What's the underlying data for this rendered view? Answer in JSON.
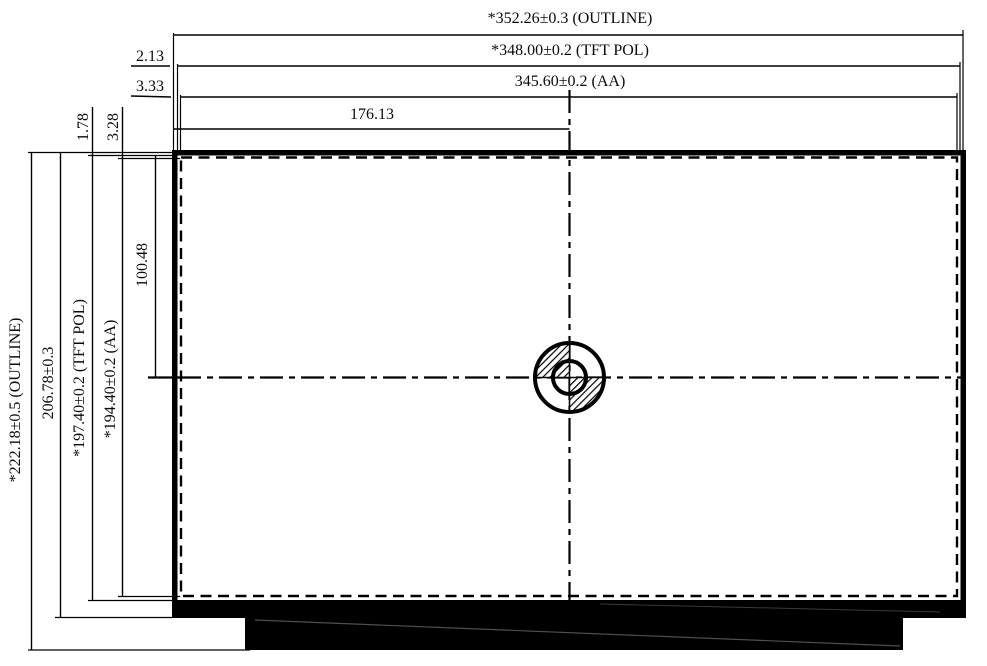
{
  "meta": {
    "type": "mechanical-outline-drawing",
    "subject": "TFT LCD module outline and active-area dimensions",
    "units": "mm"
  },
  "dimensions": {
    "horizontal": {
      "outline": "*352.26±0.3 (OUTLINE)",
      "tft_pol": "*348.00±0.2 (TFT POL)",
      "active_area": "345.60±0.2 (AA)",
      "center_offset": "176.13",
      "pol_edge_gap": "2.13",
      "aa_edge_gap": "3.33"
    },
    "vertical": {
      "outline": "*222.18±0.5 (OUTLINE)",
      "glass": "206.78±0.3",
      "tft_pol": "*197.40±0.2 (TFT POL)",
      "active_area": "*194.40±0.2 (AA)",
      "center_offset": "100.48",
      "pol_edge_gap": "1.78",
      "aa_edge_gap": "3.28"
    }
  },
  "colors": {
    "line": "#000000",
    "background": "#ffffff"
  }
}
